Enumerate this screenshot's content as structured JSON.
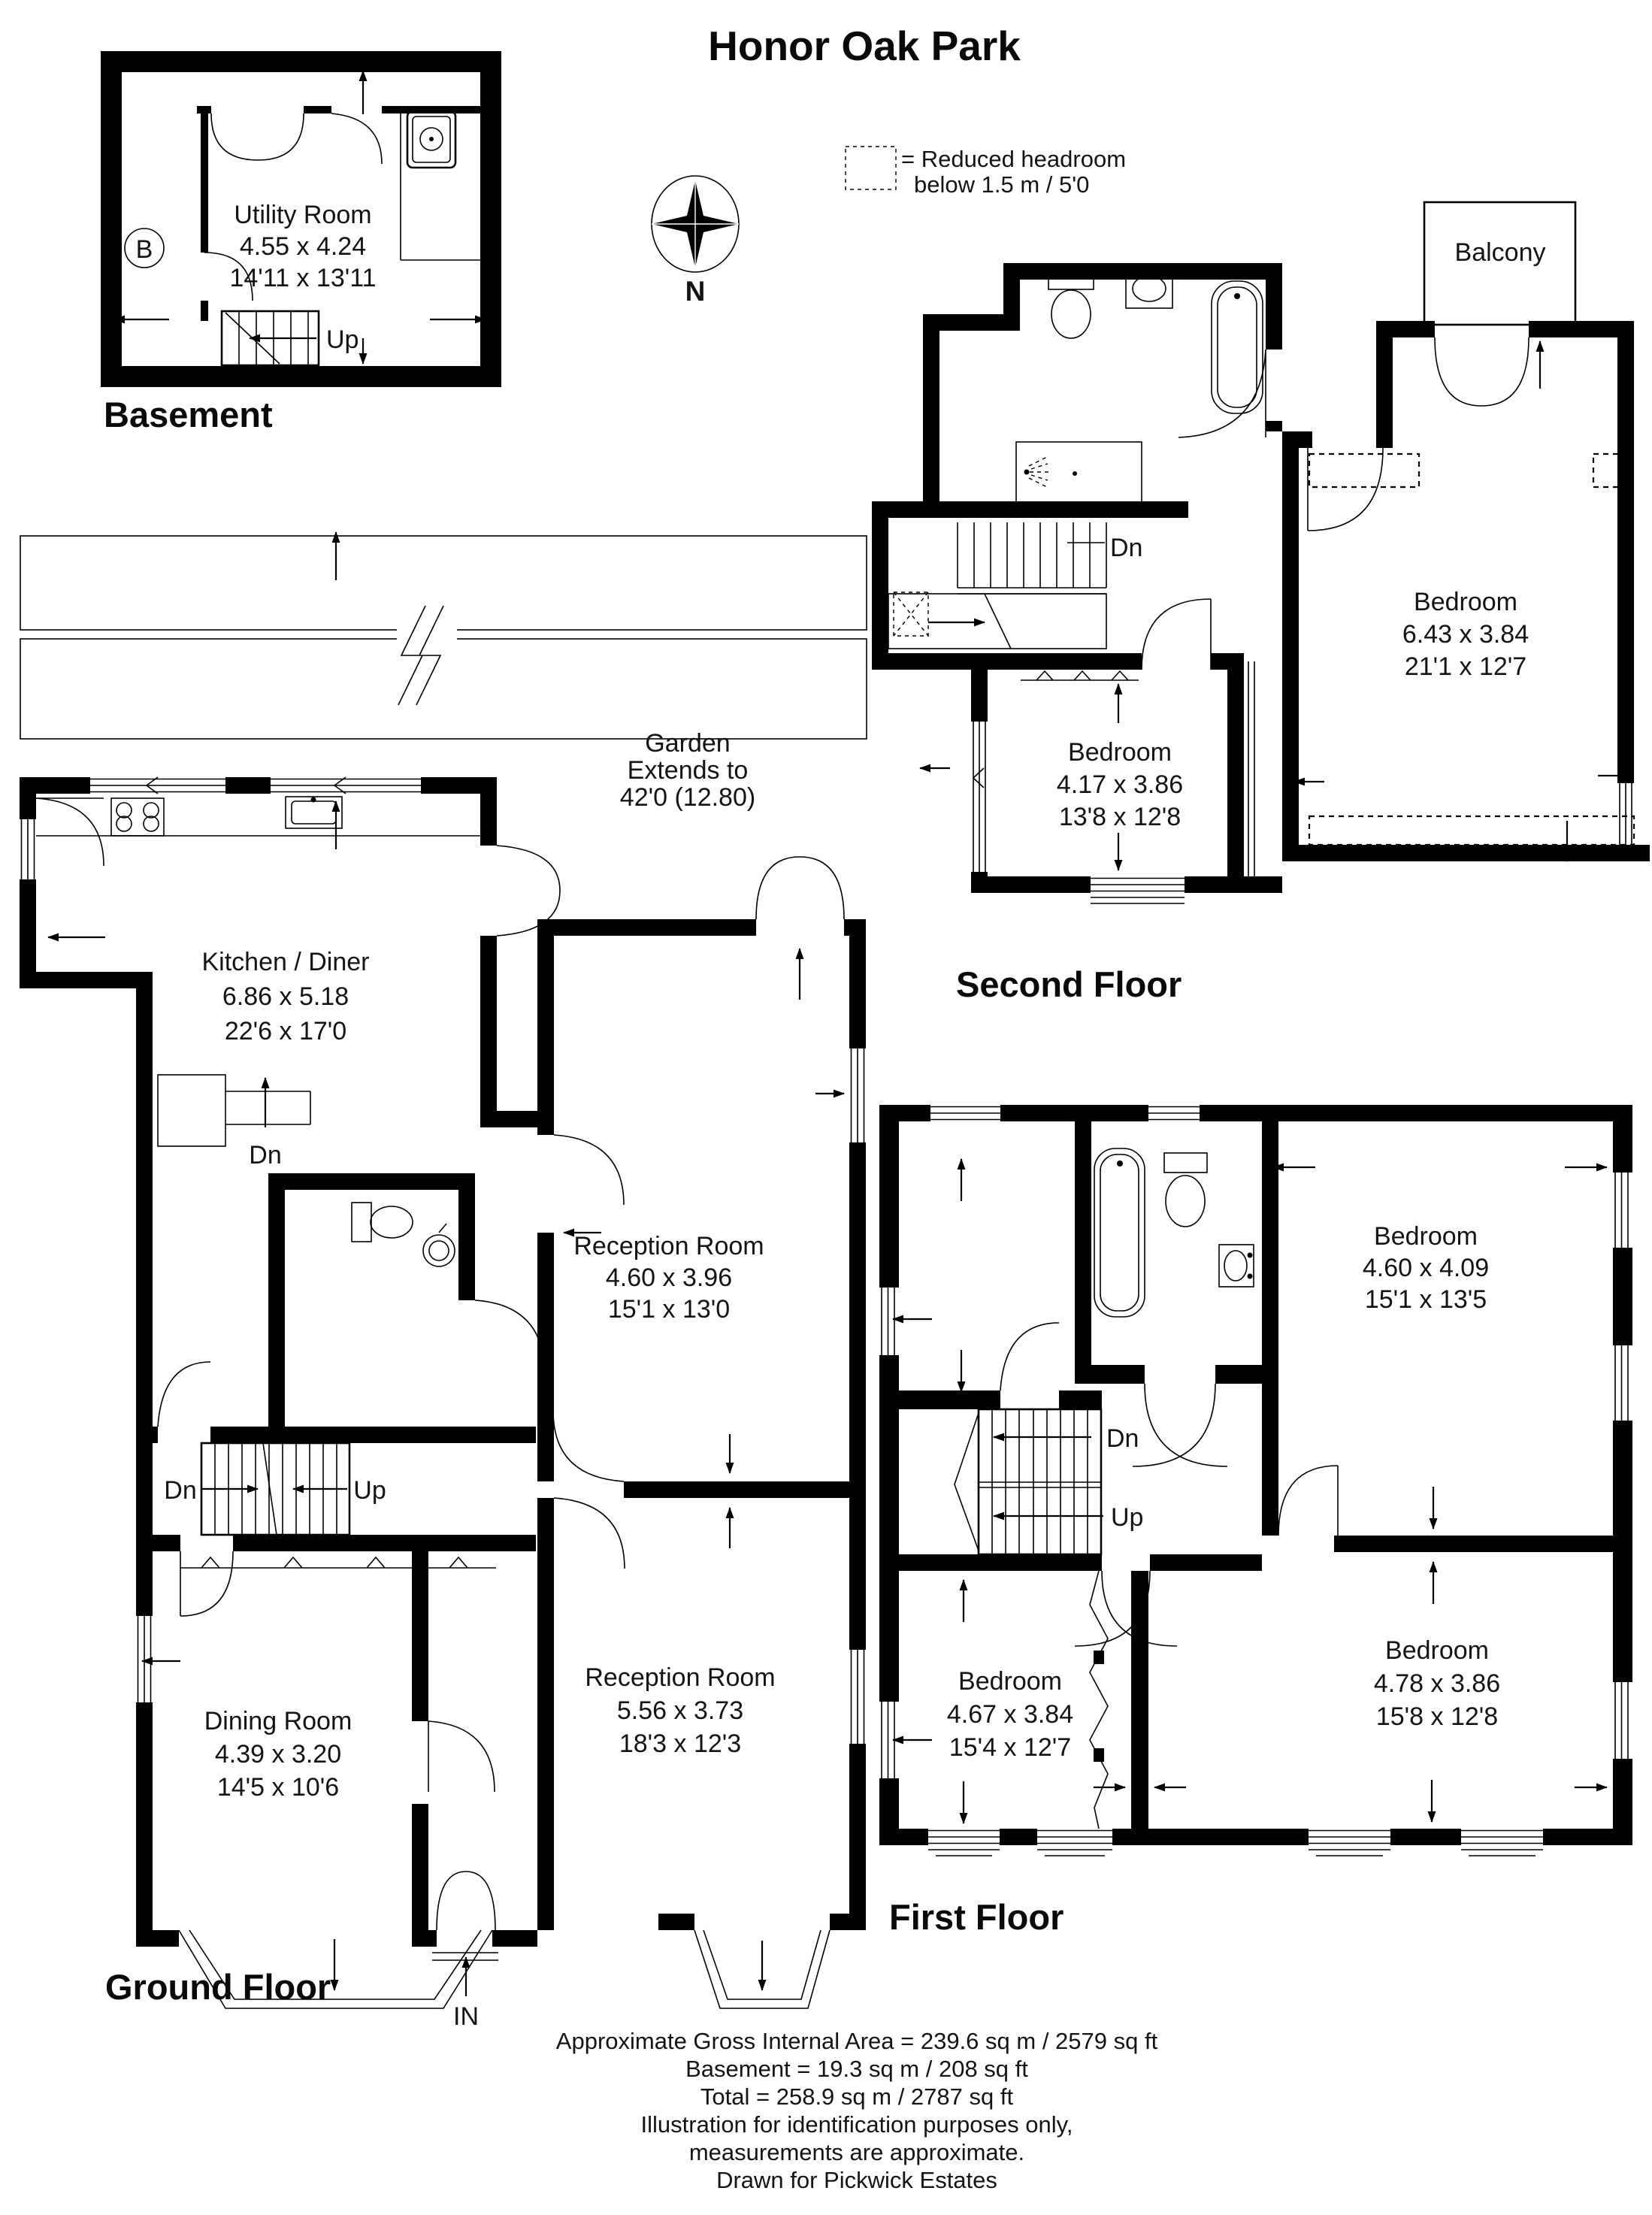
{
  "title": "Honor Oak Park",
  "legend": {
    "line1": "= Reduced headroom",
    "line2": "below 1.5 m / 5'0"
  },
  "compass": {
    "north": "N"
  },
  "basement": {
    "floor_label": "Basement",
    "marker": "B",
    "stairs": {
      "up": "Up"
    },
    "rooms": {
      "utility": {
        "name": "Utility Room",
        "metric": "4.55 x 4.24",
        "imperial": "14'11 x 13'11"
      }
    }
  },
  "ground": {
    "floor_label": "Ground Floor",
    "entrance_label": "IN",
    "garden": {
      "line1": "Garden",
      "line2": "Extends to",
      "line3": "42'0 (12.80)"
    },
    "kitchen_stairs": {
      "down": "Dn"
    },
    "stairs": {
      "down": "Dn",
      "up": "Up"
    },
    "rooms": {
      "kitchen": {
        "name": "Kitchen / Diner",
        "metric": "6.86 x 5.18",
        "imperial": "22'6 x 17'0"
      },
      "reception_rear": {
        "name": "Reception Room",
        "metric": "4.60 x 3.96",
        "imperial": "15'1 x 13'0"
      },
      "reception_front": {
        "name": "Reception Room",
        "metric": "5.56 x 3.73",
        "imperial": "18'3 x 12'3"
      },
      "dining": {
        "name": "Dining Room",
        "metric": "4.39 x 3.20",
        "imperial": "14'5 x 10'6"
      }
    }
  },
  "first": {
    "floor_label": "First Floor",
    "stairs": {
      "down": "Dn",
      "up": "Up"
    },
    "rooms": {
      "bedroom_rear": {
        "name": "Bedroom",
        "metric": "4.60 x 4.09",
        "imperial": "15'1 x 13'5"
      },
      "bedroom_front_left": {
        "name": "Bedroom",
        "metric": "4.67 x 3.84",
        "imperial": "15'4 x 12'7"
      },
      "bedroom_front_right": {
        "name": "Bedroom",
        "metric": "4.78 x 3.86",
        "imperial": "15'8 x 12'8"
      }
    }
  },
  "second": {
    "floor_label": "Second Floor",
    "balcony_label": "Balcony",
    "stairs": {
      "down": "Dn"
    },
    "rooms": {
      "bedroom_main": {
        "name": "Bedroom",
        "metric": "6.43 x 3.84",
        "imperial": "21'1 x 12'7"
      },
      "bedroom_small": {
        "name": "Bedroom",
        "metric": "4.17 x 3.86",
        "imperial": "13'8 x 12'8"
      }
    }
  },
  "footer": {
    "lines": [
      "Approximate Gross Internal Area = 239.6 sq m / 2579 sq ft",
      "Basement = 19.3 sq m / 208 sq ft",
      "Total = 258.9 sq m / 2787 sq ft",
      "Illustration for identification purposes only,",
      "measurements are approximate.",
      "Drawn for Pickwick Estates"
    ]
  }
}
